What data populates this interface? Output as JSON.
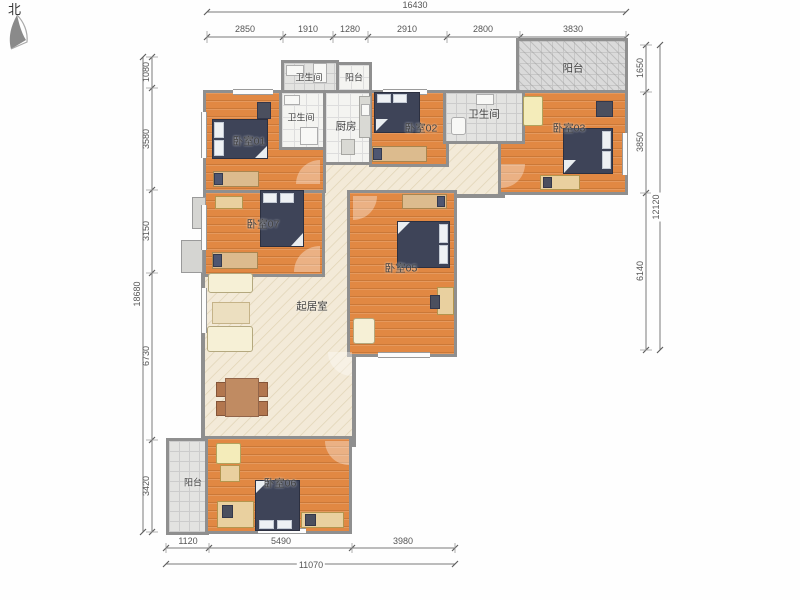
{
  "compass": {
    "label": "北"
  },
  "rooms": {
    "bath_top": "卫生间",
    "balcony_top": "阳台",
    "bedroom01": "卧室01",
    "bath_inner": "卫生间",
    "kitchen": "厨房",
    "bedroom02": "卧室02",
    "bath_right": "卫生间",
    "bedroom03": "卧室03",
    "balcony_topright": "阳台",
    "bedroom07": "卧室07",
    "bedroom05": "卧室05",
    "living": "起居室",
    "balcony_bottom": "阳台",
    "bedroom06": "卧室06"
  },
  "dimensions": {
    "top": {
      "total": "16430",
      "segments": [
        "2850",
        "1910",
        "1280",
        "2910",
        "2800",
        "3830"
      ]
    },
    "left": {
      "total": "18680",
      "segments": [
        "1080",
        "3580",
        "3150",
        "6730",
        "3420"
      ]
    },
    "right": {
      "total": "12120",
      "segments": [
        "1650",
        "3850",
        "6140"
      ]
    },
    "bottom": {
      "total": "11070",
      "segments": [
        "1120",
        "5490",
        "3980"
      ]
    }
  },
  "colors": {
    "bedroom_floor": "#e18843",
    "hall_floor": "#f3ead8",
    "tile_floor": "#e3e3e1",
    "wall": "#8f8f8f",
    "bed": "#3e4458"
  }
}
